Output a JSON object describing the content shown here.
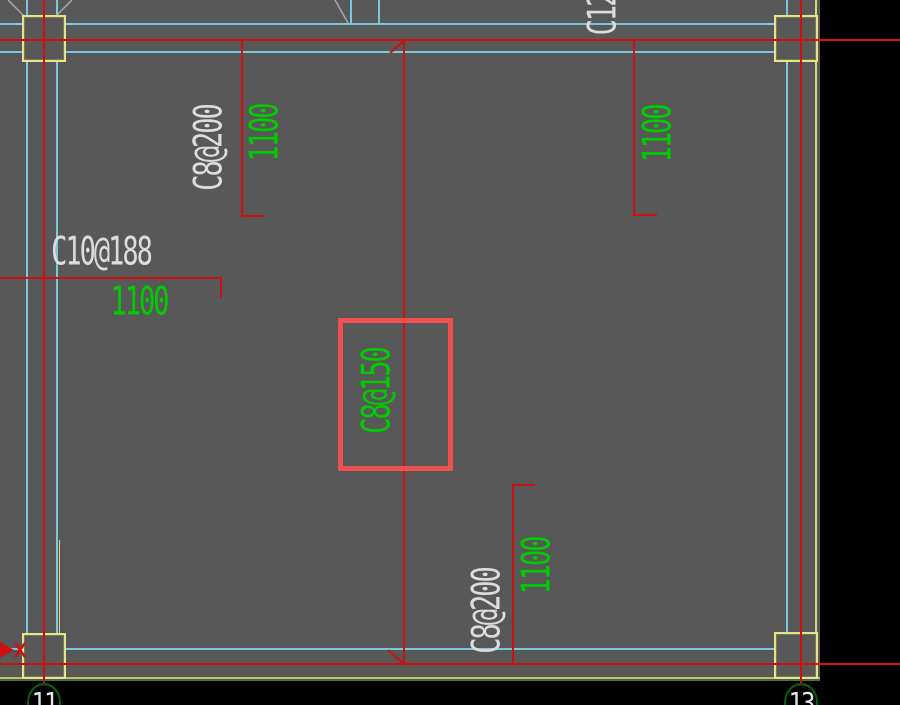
{
  "app": {
    "type": "cad-structural-plan-viewport",
    "description": "Slab reinforcement plan with a red highlight box around the selected rebar label"
  },
  "labels": {
    "rebar_top_left": "C8@200",
    "dim_top_left": "1100",
    "rebar_top_right_partial": "C12",
    "dim_top_right": "1100",
    "rebar_mid_left": "C10@188",
    "dim_mid_left": "1100",
    "rebar_center": "C8@150",
    "rebar_bottom": "C8@200",
    "dim_bottom": "1100"
  },
  "grid": {
    "bubble_left": "11",
    "bubble_right": "13"
  },
  "colors": {
    "background": "#000000",
    "floor": "#585858",
    "slab_edge_cyan": "#79c8e2",
    "grid_red": "#d01010",
    "highlight_red": "#ef5050",
    "column_yellow": "#e7e38b",
    "slab_outline_yellow_green": "#bdc558",
    "text_green": "#00cd00",
    "text_white": "#dcdcdc",
    "bubble_green": "#0c5c10"
  }
}
